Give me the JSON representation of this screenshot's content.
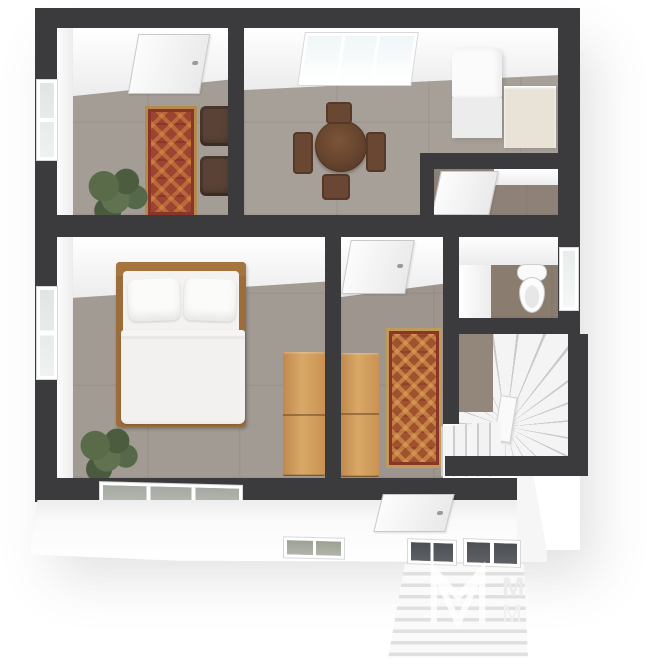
{
  "meta": {
    "image_type": "3d-floor-plan-render",
    "view": "top-down dollhouse perspective",
    "background": "#ffffff"
  },
  "watermark": {
    "logo": "m-monogram-outline",
    "text_top": "M",
    "text_bottom": "M"
  },
  "palette": {
    "wall_top": "#3b3b3d",
    "wall_face_white": "#f2f2f2",
    "floor_main_taupe": "#a29b94",
    "floor_closet": "#8e8278",
    "floor_bathroom": "#8a7c6f",
    "rug_red": "#9c4331",
    "rug_accent_gold": "#b3894e",
    "wood_bed_frame": "#9c6d3a",
    "wood_dresser_oak": "#d9a866",
    "wood_table_dark": "#6a4733",
    "armchair_brown": "#5a4336",
    "plant_green": "#57684a",
    "stairs_white": "#f1f1f1",
    "glass_dark": "#53565a"
  },
  "rooms": [
    {
      "name": "sitting-room",
      "position": "top-left",
      "contents": [
        "door",
        "left-wall-window",
        "red-runner-rug",
        "armchair",
        "armchair",
        "potted-plant"
      ]
    },
    {
      "name": "dining-room",
      "position": "top-center",
      "contents": [
        "triple-window",
        "round-dining-table",
        "dining-chair",
        "dining-chair",
        "dining-chair",
        "dining-chair",
        "tall-white-cabinet",
        "counter"
      ]
    },
    {
      "name": "closet",
      "position": "upper-right",
      "contents": [
        "door"
      ]
    },
    {
      "name": "bedroom",
      "position": "center-left",
      "contents": [
        "double-bed",
        "pillow",
        "pillow",
        "duvet",
        "left-wall-window",
        "bottom-wall-triple-window",
        "potted-plant",
        "oak-dresser"
      ]
    },
    {
      "name": "hallway",
      "position": "center",
      "contents": [
        "door",
        "oak-dresser",
        "red-runner-rug",
        "front-door"
      ]
    },
    {
      "name": "bathroom",
      "position": "right-middle",
      "contents": [
        "toilet",
        "right-wall-window"
      ]
    },
    {
      "name": "staircase",
      "position": "bottom-right",
      "contents": [
        "winder-stairs",
        "straight-treads",
        "newel-wall"
      ]
    }
  ],
  "exterior": {
    "contents": [
      "front-facade",
      "facade-window",
      "entry-glazing-left",
      "entry-glazing-right",
      "entry-steps",
      "facade-corner"
    ]
  }
}
